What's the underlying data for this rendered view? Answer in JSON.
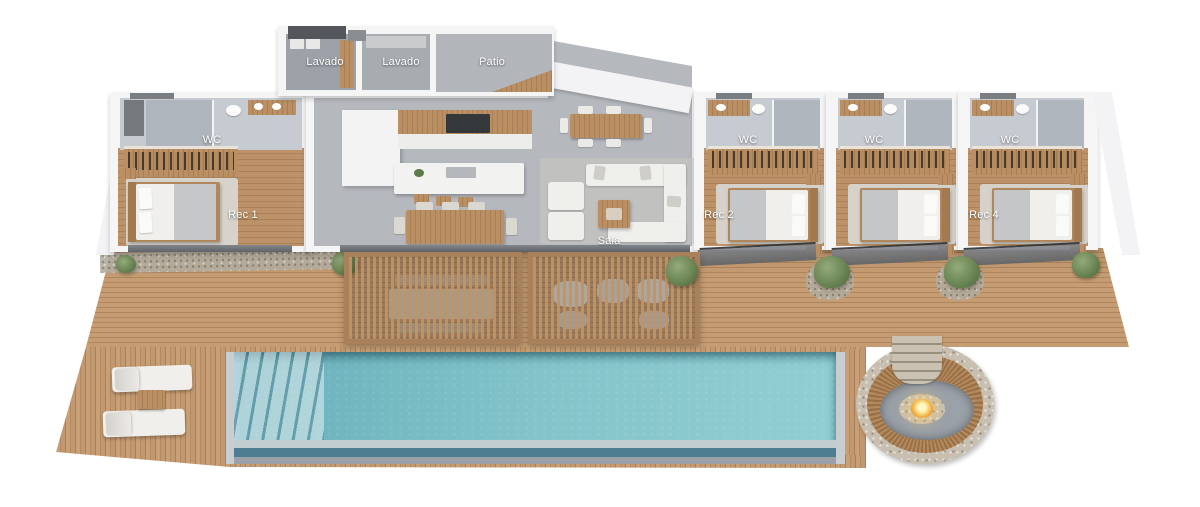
{
  "plan": {
    "rooms": [
      {
        "id": "lavado-1",
        "label": "Lavado"
      },
      {
        "id": "lavado-2",
        "label": "Lavado"
      },
      {
        "id": "patio",
        "label": "Patio"
      },
      {
        "id": "wc-rec-1",
        "label": "WC"
      },
      {
        "id": "rec-1",
        "label": "Rec 1"
      },
      {
        "id": "wc-rec-2",
        "label": "WC"
      },
      {
        "id": "rec-2",
        "label": "Rec 2"
      },
      {
        "id": "wc-rec-3",
        "label": "WC"
      },
      {
        "id": "wc-rec-4",
        "label": "WC"
      },
      {
        "id": "rec-4",
        "label": "Rec 4"
      },
      {
        "id": "sala",
        "label": "Sala"
      }
    ],
    "colors": {
      "deck_wood": "#c49a6c",
      "pool_water": "#7bbcc6",
      "wall_white": "#f5f5f6",
      "concrete_floor": "#b5b9be",
      "bedroom_wood": "#b5895f",
      "fire_glow": "#f7c963",
      "plant_green": "#6d8455"
    }
  }
}
